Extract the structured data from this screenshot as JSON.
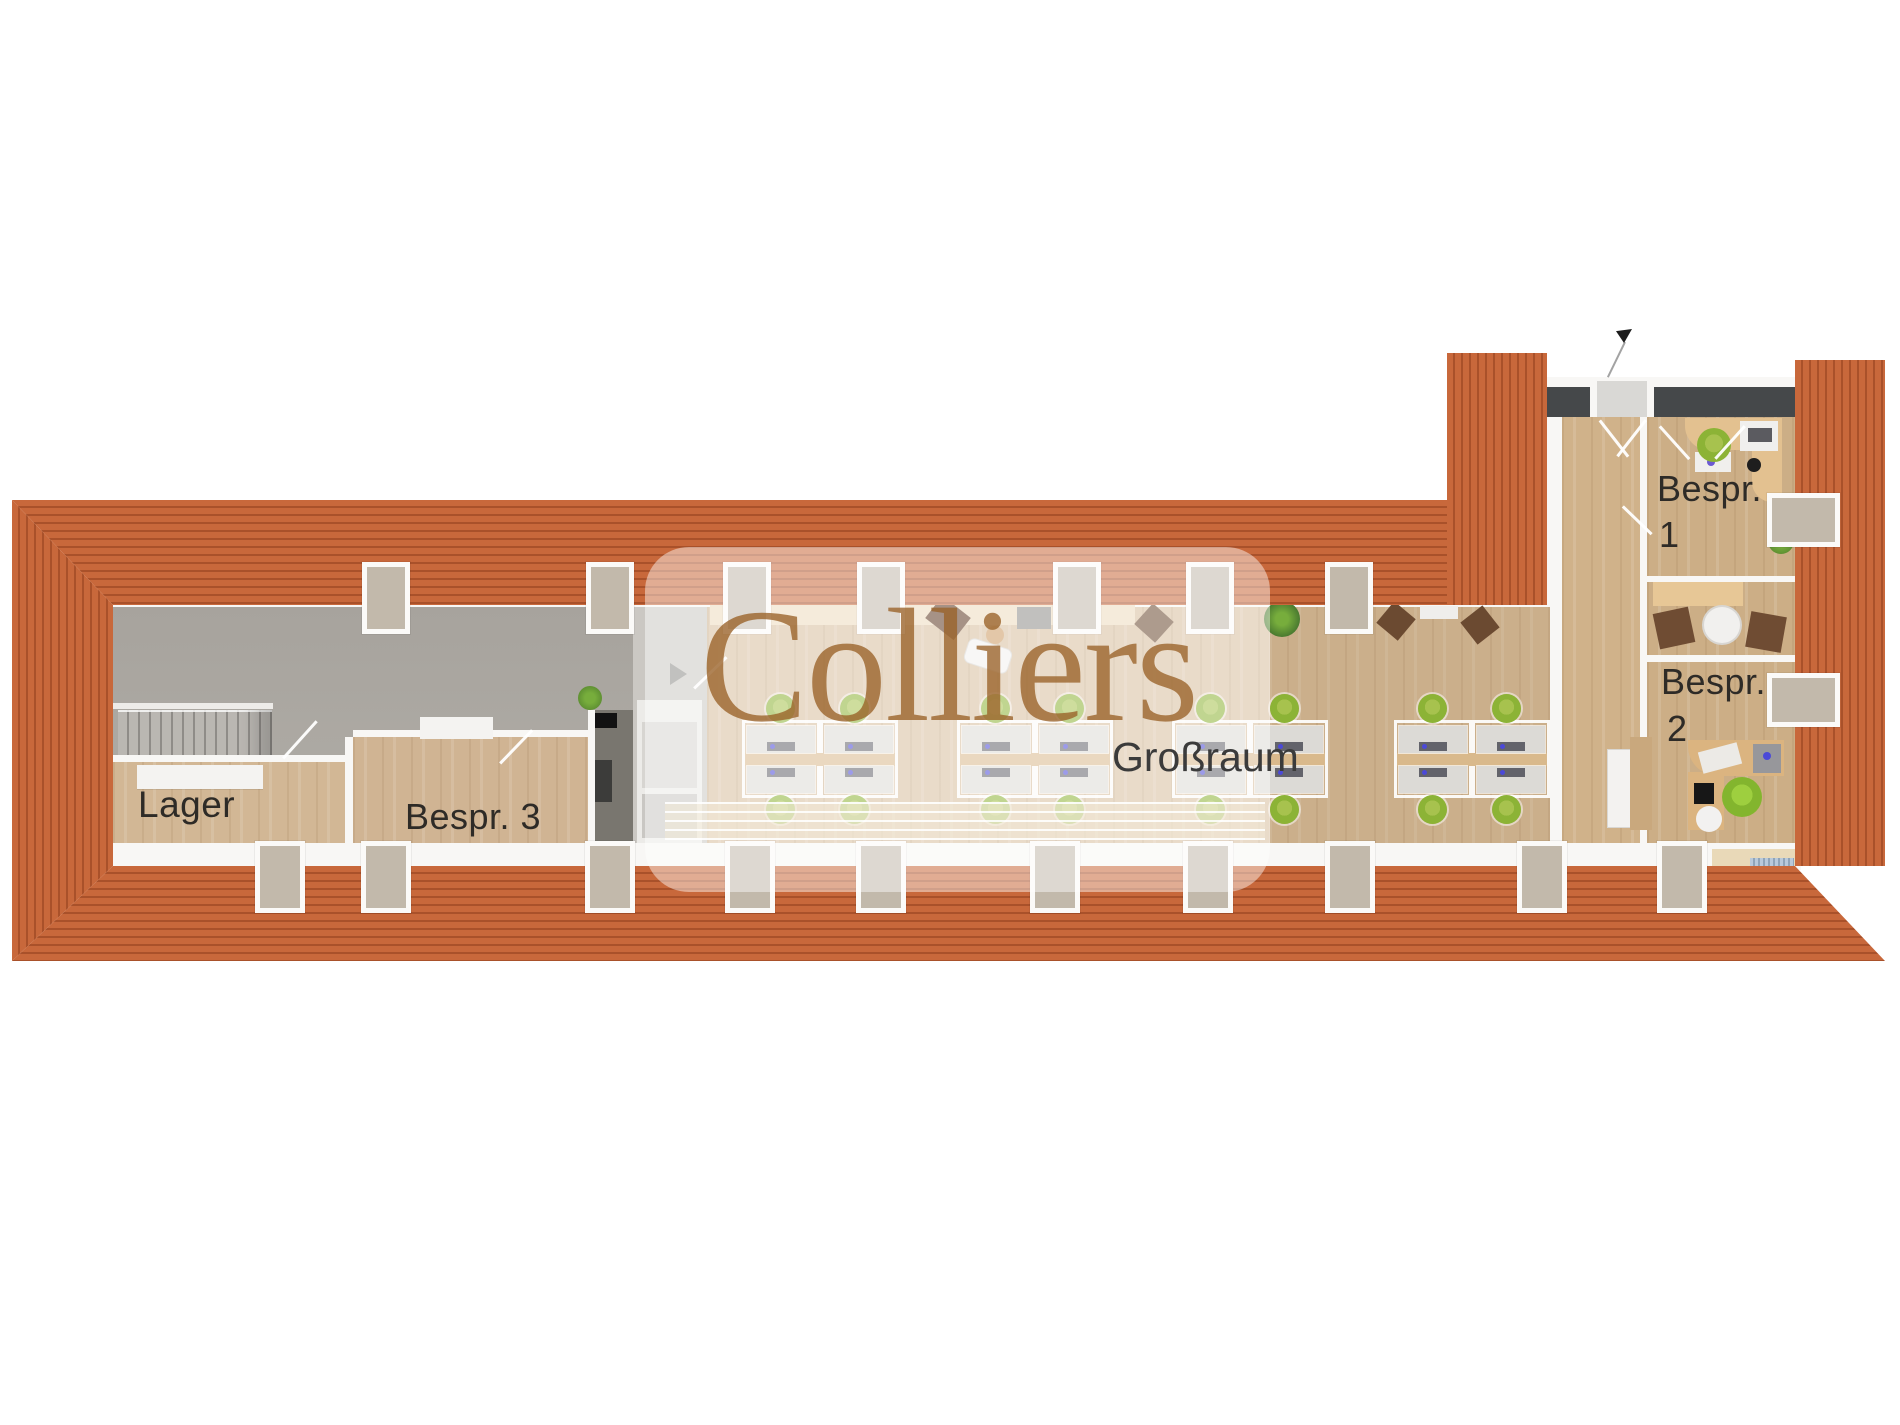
{
  "watermark": {
    "brand": "Colliers"
  },
  "rooms": {
    "lager": {
      "label": "Lager"
    },
    "bespr_3": {
      "label": "Bespr. 3"
    },
    "bespr_1": {
      "label_line1": "Bespr.",
      "label_line2": "1"
    },
    "bespr_2": {
      "label_line1": "Bespr.",
      "label_line2": "2"
    },
    "grossraum": {
      "label": "Großraum"
    }
  },
  "colors": {
    "roof_base": "#c8683b",
    "roof_line": "#a9512a",
    "wood_floor": "#d7bd9d",
    "wood_room": "#ccae86",
    "gray_floor": "#a8a49e",
    "gray_floor_light": "#cbc8c3",
    "wall_white": "#f8f7f5",
    "wall_dark": "#45484a",
    "skylight_fill": "#c2b9ab",
    "skylight_frame": "#fbfaf8",
    "chair_green": "#8cb336",
    "brand_brown": "#9a6228",
    "label_dark": "#2e2b27"
  },
  "skylights": {
    "top_x": [
      386,
      610,
      747,
      881,
      1077,
      1210,
      1349
    ],
    "bottom_x": [
      280,
      386,
      610,
      750,
      881,
      1055,
      1208,
      1350,
      1542,
      1682
    ],
    "right_y": [
      520,
      700
    ]
  },
  "desk_clusters_x": [
    745,
    960,
    1175,
    1397
  ]
}
